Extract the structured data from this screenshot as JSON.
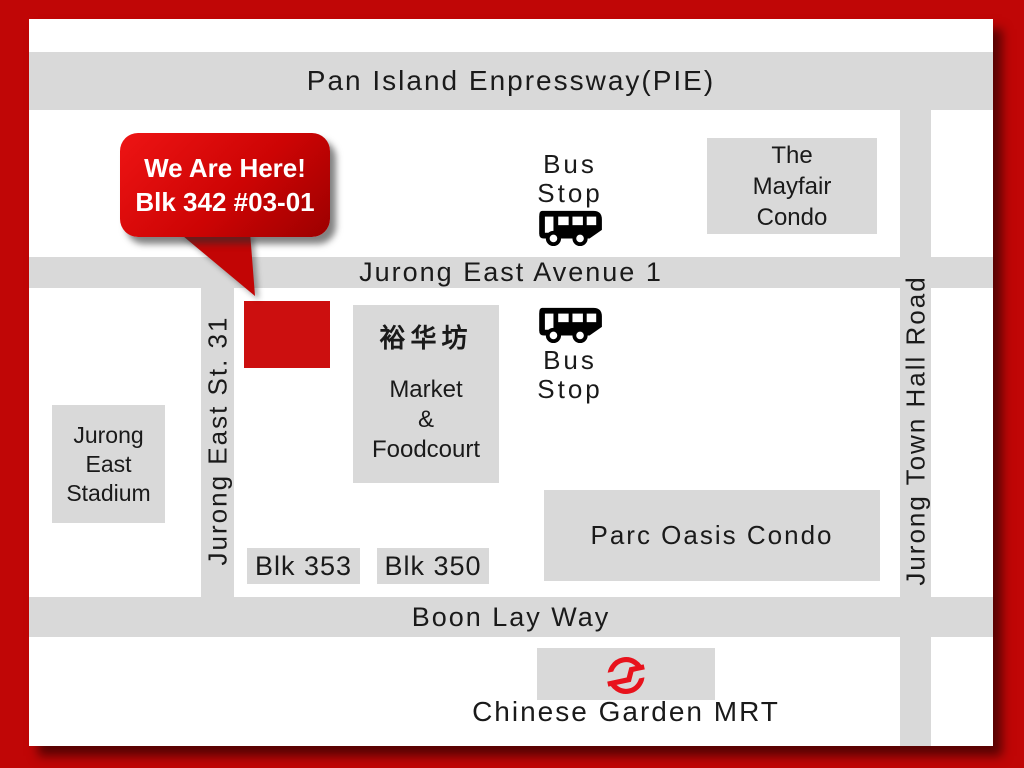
{
  "colors": {
    "frame_red": "#c00606",
    "road_gray": "#d9d9d9",
    "marker_red": "#cc0f0f",
    "bubble_red": "#cd0404",
    "mrt_logo_red": "#e8121c",
    "text_black": "#1a1a1a"
  },
  "roads": {
    "pie": "Pan Island Enpressway(PIE)",
    "avenue": "Jurong East Avenue 1",
    "boon_lay": "Boon Lay Way",
    "town_hall": "Jurong Town Hall Road",
    "st31": "Jurong East St. 31"
  },
  "marker": {
    "line1": "We Are Here!",
    "line2": "Blk 342 #03-01"
  },
  "bus_stop_top": {
    "line1": "Bus",
    "line2": "Stop"
  },
  "bus_stop_mid": {
    "line1": "Bus",
    "line2": "Stop"
  },
  "places": {
    "mayfair": {
      "line1": "The",
      "line2": "Mayfair",
      "line3": "Condo"
    },
    "market": {
      "title": "裕华坊",
      "line1": "Market",
      "line2": "&",
      "line3": "Foodcourt"
    },
    "stadium": {
      "line1": "Jurong",
      "line2": "East",
      "line3": "Stadium"
    },
    "parc_oasis": "Parc Oasis Condo",
    "blk353": "Blk 353",
    "blk350": "Blk 350",
    "mrt_station": "Chinese Garden MRT"
  }
}
